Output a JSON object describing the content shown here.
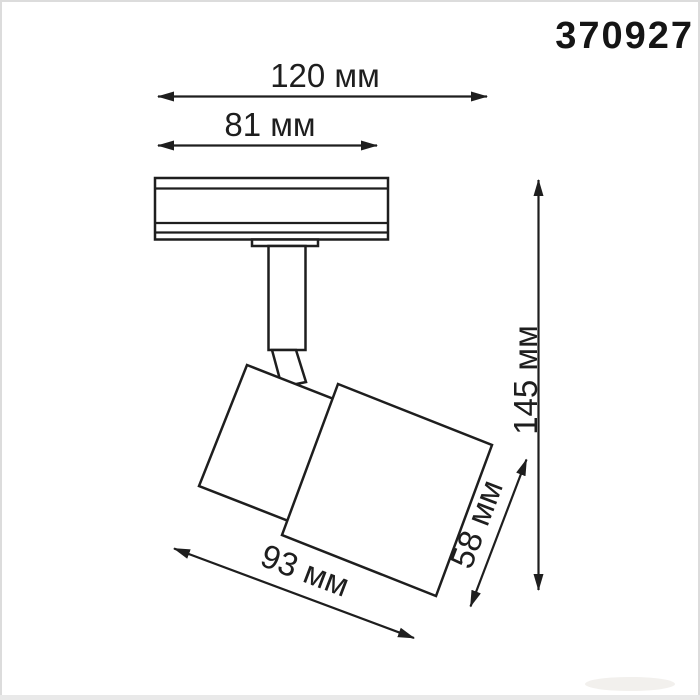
{
  "article": "370927",
  "diagram": {
    "type": "dimensional-drawing",
    "subject": "track-mounted spotlight",
    "colors": {
      "line": "#1e1e1e",
      "background": "#ffffff",
      "frame": "#dcdcdc"
    },
    "dimensions": [
      {
        "id": "overall-width",
        "label": "120 мм",
        "value": 120,
        "unit": "мм",
        "orientation": "horizontal"
      },
      {
        "id": "base-width",
        "label": "81 мм",
        "value": 81,
        "unit": "мм",
        "orientation": "horizontal"
      },
      {
        "id": "overall-height",
        "label": "145 мм",
        "value": 145,
        "unit": "мм",
        "orientation": "vertical"
      },
      {
        "id": "body-length",
        "label": "93 мм",
        "value": 93,
        "unit": "мм",
        "orientation": "diagonal"
      },
      {
        "id": "body-width",
        "label": "58 мм",
        "value": 58,
        "unit": "мм",
        "orientation": "diagonal"
      }
    ]
  }
}
